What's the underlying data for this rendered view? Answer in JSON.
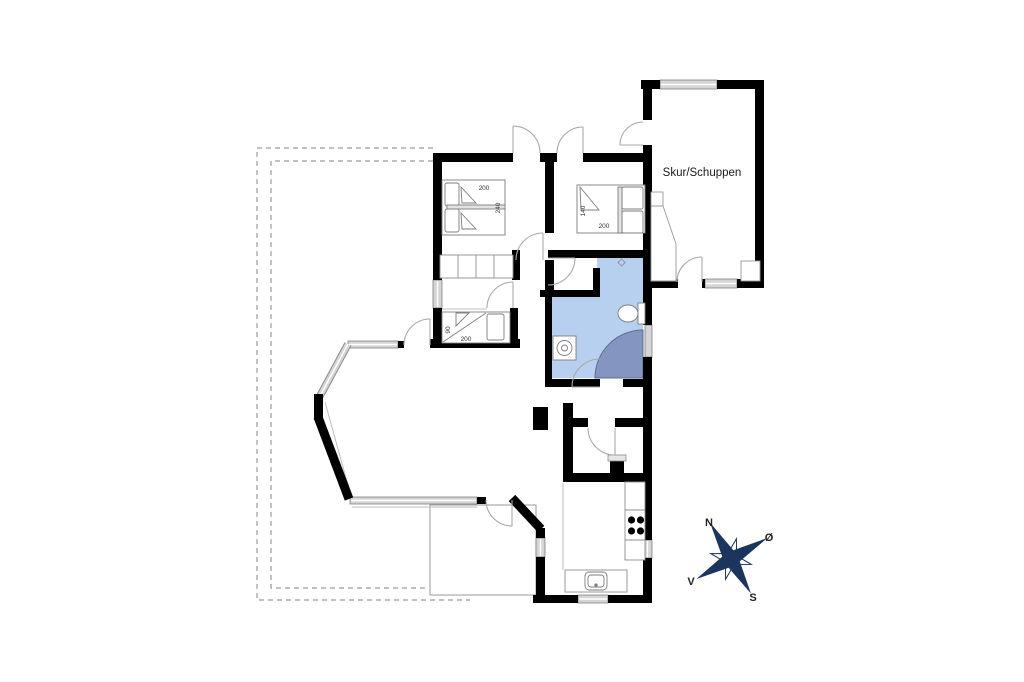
{
  "plan": {
    "shed_label": "Skur/Schuppen"
  },
  "beds": {
    "bed1": {
      "dim_top": "200",
      "dim_side": "240"
    },
    "bed2": {
      "dim_side": "140",
      "dim_bottom": "200"
    },
    "bed3": {
      "dim_side": "90",
      "dim_bottom": "200"
    }
  },
  "compass": {
    "north": "N",
    "east": "Ø",
    "south": "S",
    "west": "V"
  },
  "colors": {
    "wall": "#000000",
    "bathroom": "#b8d0ef",
    "shower": "#8395c0",
    "window": "#d5d5d5",
    "compass": "#1c355e"
  }
}
